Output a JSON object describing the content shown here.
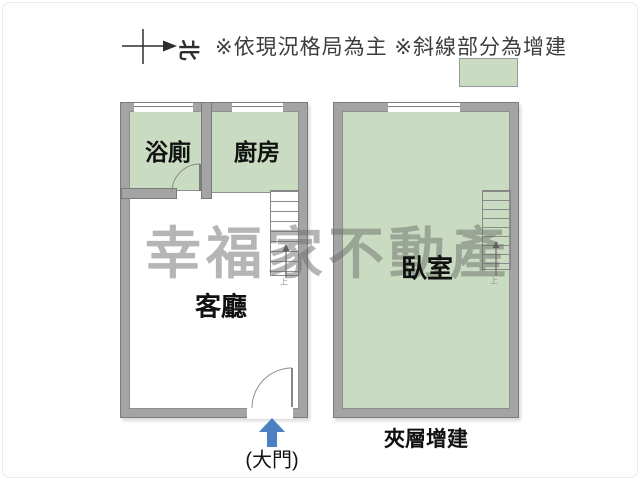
{
  "colors": {
    "addition_green": "#c9dcc1",
    "wall_gray": "#a4a4a4",
    "wall_edge": "#7b7b7b",
    "arrow_blue": "#4b80c3",
    "watermark": "rgba(108,110,106,0.5)"
  },
  "header": {
    "compass_north": "北",
    "notice": "※依現況格局為主 ※斜線部分為增建"
  },
  "watermark": "幸福家不動產",
  "rooms": {
    "bathroom": "浴廁",
    "kitchen": "廚房",
    "living_room": "客廳",
    "bedroom": "臥室"
  },
  "annotations": {
    "mezzanine": "夾層增建",
    "main_door": "(大門)",
    "stair_up_left": "上",
    "stair_up_right": "上"
  }
}
